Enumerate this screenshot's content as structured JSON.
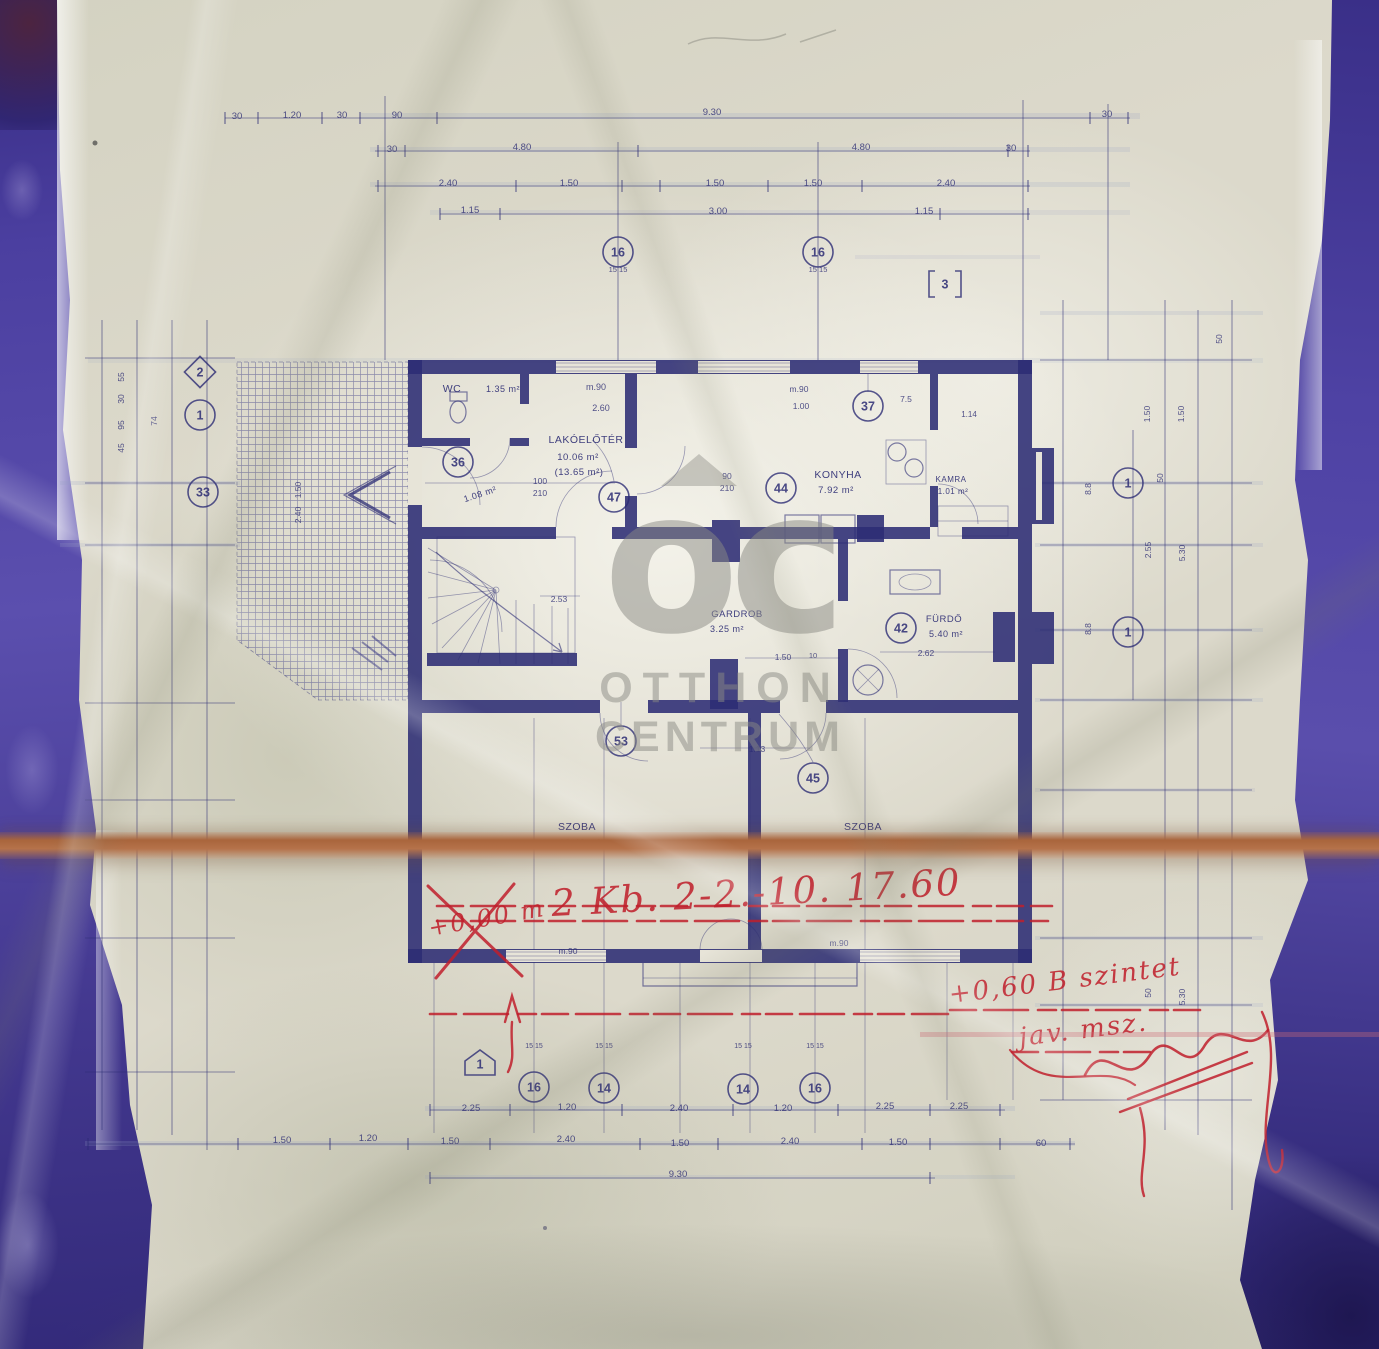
{
  "watermark": {
    "logo": "oc",
    "line1": "OTTHON",
    "line2": "CENTRUM"
  },
  "colors": {
    "ink": "#2c2c74",
    "red": "#c01f2b",
    "border_blue": "#4b3fa0",
    "tape_brown": "#b06f45",
    "paper": "#dcd9cb",
    "watermark_gray": "#8b8b86"
  },
  "rooms": [
    {
      "name": "WC",
      "area": "1.35 m²",
      "nx": 452,
      "ny": 392,
      "fs": 10.5,
      "ax": 503,
      "ay": 392,
      "afs": 9
    },
    {
      "name": "",
      "area": "1.08 m²",
      "ax": 481,
      "ay": 497,
      "afs": 9,
      "arot": -18
    },
    {
      "name": "LAKÓELŐTÉR",
      "area": "10.06 m²",
      "area2": "(13.65 m²)",
      "nx": 586,
      "ny": 443,
      "fs": 10.5,
      "ax": 578,
      "ay": 460,
      "afs": 9.5,
      "a2x": 579,
      "a2y": 475
    },
    {
      "name": "KONYHA",
      "area": "7.92 m²",
      "nx": 838,
      "ny": 478,
      "fs": 10.5,
      "ax": 836,
      "ay": 493,
      "afs": 9.5
    },
    {
      "name": "KAMRA",
      "area": "1.01 m²",
      "nx": 951,
      "ny": 482,
      "fs": 8,
      "ax": 953,
      "ay": 494,
      "afs": 8
    },
    {
      "name": "GARDROB",
      "area": "3.25 m²",
      "nx": 737,
      "ny": 617,
      "fs": 9.5,
      "ax": 727,
      "ay": 632,
      "afs": 9
    },
    {
      "name": "FÜRDŐ",
      "area": "5.40 m²",
      "nx": 944,
      "ny": 622,
      "fs": 9.5,
      "ax": 946,
      "ay": 637,
      "afs": 9
    },
    {
      "name": "SZOBA",
      "area": "18.40 m²",
      "nx": 577,
      "ny": 830,
      "fs": 10.5,
      "ax": 580,
      "ay": 846,
      "afs": 9.5
    },
    {
      "name": "SZOBA",
      "area": "15.54 m²",
      "nx": 863,
      "ny": 830,
      "fs": 10.5,
      "ax": 868,
      "ay": 847,
      "afs": 9.5
    }
  ],
  "dim_labels": [
    {
      "t": "30",
      "x": 237,
      "y": 119
    },
    {
      "t": "1.20",
      "x": 292,
      "y": 118
    },
    {
      "t": "30",
      "x": 342,
      "y": 118
    },
    {
      "t": "90",
      "x": 397,
      "y": 118
    },
    {
      "t": "9.30",
      "x": 712,
      "y": 115
    },
    {
      "t": "30",
      "x": 1107,
      "y": 117
    },
    {
      "t": "30",
      "x": 392,
      "y": 152
    },
    {
      "t": "4.80",
      "x": 522,
      "y": 150
    },
    {
      "t": "4.80",
      "x": 861,
      "y": 150
    },
    {
      "t": "30",
      "x": 1011,
      "y": 151
    },
    {
      "t": "2.40",
      "x": 448,
      "y": 186
    },
    {
      "t": "1.50",
      "x": 569,
      "y": 186
    },
    {
      "t": "1.50",
      "x": 715,
      "y": 186
    },
    {
      "t": "1.50",
      "x": 813,
      "y": 186
    },
    {
      "t": "2.40",
      "x": 946,
      "y": 186
    },
    {
      "t": "1.15",
      "x": 470,
      "y": 213
    },
    {
      "t": "3.00",
      "x": 718,
      "y": 214
    },
    {
      "t": "1.15",
      "x": 924,
      "y": 214
    },
    {
      "t": "15 15",
      "x": 618,
      "y": 272,
      "fs": 7.5
    },
    {
      "t": "15 15",
      "x": 818,
      "y": 272,
      "fs": 7.5
    },
    {
      "t": "m.90",
      "x": 596,
      "y": 390,
      "fs": 9
    },
    {
      "t": "2.60",
      "x": 601,
      "y": 411,
      "fs": 9
    },
    {
      "t": "m.90",
      "x": 799,
      "y": 392,
      "fs": 8.5
    },
    {
      "t": "1.00",
      "x": 801,
      "y": 409,
      "fs": 8.5
    },
    {
      "t": "7.5",
      "x": 906,
      "y": 402,
      "fs": 8.5
    },
    {
      "t": "1.14",
      "x": 969,
      "y": 417,
      "fs": 8
    },
    {
      "t": "90",
      "x": 727,
      "y": 479,
      "fs": 8.5
    },
    {
      "t": "210",
      "x": 727,
      "y": 491,
      "fs": 8.5
    },
    {
      "t": "100",
      "x": 540,
      "y": 484,
      "fs": 8.5
    },
    {
      "t": "210",
      "x": 540,
      "y": 496,
      "fs": 8.5
    },
    {
      "t": "2.53",
      "x": 559,
      "y": 602,
      "fs": 8.5
    },
    {
      "t": "1.50",
      "x": 783,
      "y": 660,
      "fs": 8.5
    },
    {
      "t": "10",
      "x": 813,
      "y": 658,
      "fs": 7.5
    },
    {
      "t": "2.62",
      "x": 926,
      "y": 656,
      "fs": 8.5
    },
    {
      "t": "1.13",
      "x": 757,
      "y": 752,
      "fs": 8.5
    },
    {
      "t": "m.90",
      "x": 568,
      "y": 954,
      "fs": 8.5
    },
    {
      "t": "m.90",
      "x": 839,
      "y": 946,
      "fs": 8.5
    },
    {
      "t": "55",
      "x": 124,
      "y": 377,
      "rot": -90,
      "fs": 8.5
    },
    {
      "t": "30",
      "x": 124,
      "y": 399,
      "rot": -90,
      "fs": 8.5
    },
    {
      "t": "95",
      "x": 124,
      "y": 425,
      "rot": -90,
      "fs": 8.5
    },
    {
      "t": "45",
      "x": 124,
      "y": 448,
      "rot": -90,
      "fs": 8.5
    },
    {
      "t": "74",
      "x": 157,
      "y": 421,
      "rot": -90,
      "fs": 8.5
    },
    {
      "t": "1.50",
      "x": 301,
      "y": 490,
      "rot": -90,
      "fs": 8.5
    },
    {
      "t": "2.40",
      "x": 301,
      "y": 515,
      "rot": -90,
      "fs": 8.5
    },
    {
      "t": "50",
      "x": 1222,
      "y": 339,
      "rot": -90,
      "fs": 8.5
    },
    {
      "t": "1.50",
      "x": 1150,
      "y": 414,
      "rot": -90,
      "fs": 8.5
    },
    {
      "t": "1.50",
      "x": 1184,
      "y": 414,
      "rot": -90,
      "fs": 8.5
    },
    {
      "t": "50",
      "x": 1163,
      "y": 478,
      "rot": -90,
      "fs": 8.5
    },
    {
      "t": "8.8",
      "x": 1091,
      "y": 489,
      "rot": -90,
      "fs": 8.5
    },
    {
      "t": "2.55",
      "x": 1151,
      "y": 550,
      "rot": -90,
      "fs": 8.5
    },
    {
      "t": "5.30",
      "x": 1185,
      "y": 553,
      "rot": -90,
      "fs": 8.5
    },
    {
      "t": "8.8",
      "x": 1091,
      "y": 629,
      "rot": -90,
      "fs": 8.5
    },
    {
      "t": "50",
      "x": 1151,
      "y": 993,
      "rot": -90,
      "fs": 8.5
    },
    {
      "t": "5.30",
      "x": 1185,
      "y": 997,
      "rot": -90,
      "fs": 8.5
    },
    {
      "t": "2.25",
      "x": 471,
      "y": 1111
    },
    {
      "t": "1.20",
      "x": 567,
      "y": 1110
    },
    {
      "t": "2.40",
      "x": 679,
      "y": 1111
    },
    {
      "t": "1.20",
      "x": 783,
      "y": 1111
    },
    {
      "t": "2.25",
      "x": 885,
      "y": 1109
    },
    {
      "t": "2.25",
      "x": 959,
      "y": 1109
    },
    {
      "t": "1.50",
      "x": 282,
      "y": 1143
    },
    {
      "t": "1.20",
      "x": 368,
      "y": 1141
    },
    {
      "t": "1.50",
      "x": 450,
      "y": 1144
    },
    {
      "t": "2.40",
      "x": 566,
      "y": 1142
    },
    {
      "t": "1.50",
      "x": 680,
      "y": 1146
    },
    {
      "t": "2.40",
      "x": 790,
      "y": 1144
    },
    {
      "t": "1.50",
      "x": 898,
      "y": 1145
    },
    {
      "t": "60",
      "x": 1041,
      "y": 1146
    },
    {
      "t": "9.30",
      "x": 678,
      "y": 1177
    },
    {
      "t": "15 15",
      "x": 534,
      "y": 1048,
      "fs": 7
    },
    {
      "t": "15 15",
      "x": 604,
      "y": 1048,
      "fs": 7
    },
    {
      "t": "15 15",
      "x": 743,
      "y": 1048,
      "fs": 7
    },
    {
      "t": "15 15",
      "x": 815,
      "y": 1048,
      "fs": 7
    }
  ],
  "markers": [
    {
      "t": "36",
      "x": 458,
      "y": 462
    },
    {
      "t": "47",
      "x": 614,
      "y": 497
    },
    {
      "t": "44",
      "x": 781,
      "y": 488
    },
    {
      "t": "37",
      "x": 868,
      "y": 406
    },
    {
      "t": "42",
      "x": 901,
      "y": 628
    },
    {
      "t": "53",
      "x": 621,
      "y": 741
    },
    {
      "t": "45",
      "x": 813,
      "y": 778
    },
    {
      "t": "33",
      "x": 203,
      "y": 492
    },
    {
      "t": "1",
      "x": 200,
      "y": 415
    },
    {
      "t": "2",
      "x": 200,
      "y": 372,
      "shape": "diamond"
    },
    {
      "t": "16",
      "x": 618,
      "y": 252
    },
    {
      "t": "16",
      "x": 818,
      "y": 252
    },
    {
      "t": "3",
      "x": 945,
      "y": 284,
      "shape": "bracket"
    },
    {
      "t": "1",
      "x": 1128,
      "y": 483
    },
    {
      "t": "1",
      "x": 1128,
      "y": 632
    },
    {
      "t": "16",
      "x": 534,
      "y": 1087
    },
    {
      "t": "14",
      "x": 604,
      "y": 1088
    },
    {
      "t": "14",
      "x": 743,
      "y": 1089
    },
    {
      "t": "16",
      "x": 815,
      "y": 1088
    },
    {
      "t": "1",
      "x": 480,
      "y": 1064,
      "shape": "pentagon"
    }
  ],
  "red_notes": [
    {
      "t": "2 Kb. 2-2.-10. 17.60",
      "x": 552,
      "y": 916,
      "fs": 37,
      "rot": -3
    },
    {
      "t": "+0,00 m",
      "x": 430,
      "y": 936,
      "fs": 24,
      "rot": -10
    },
    {
      "t": "+0,60 B szintet",
      "x": 950,
      "y": 1003,
      "fs": 26,
      "rot": -7
    },
    {
      "t": "jav. msz.",
      "x": 1020,
      "y": 1046,
      "fs": 26,
      "rot": -7
    }
  ]
}
